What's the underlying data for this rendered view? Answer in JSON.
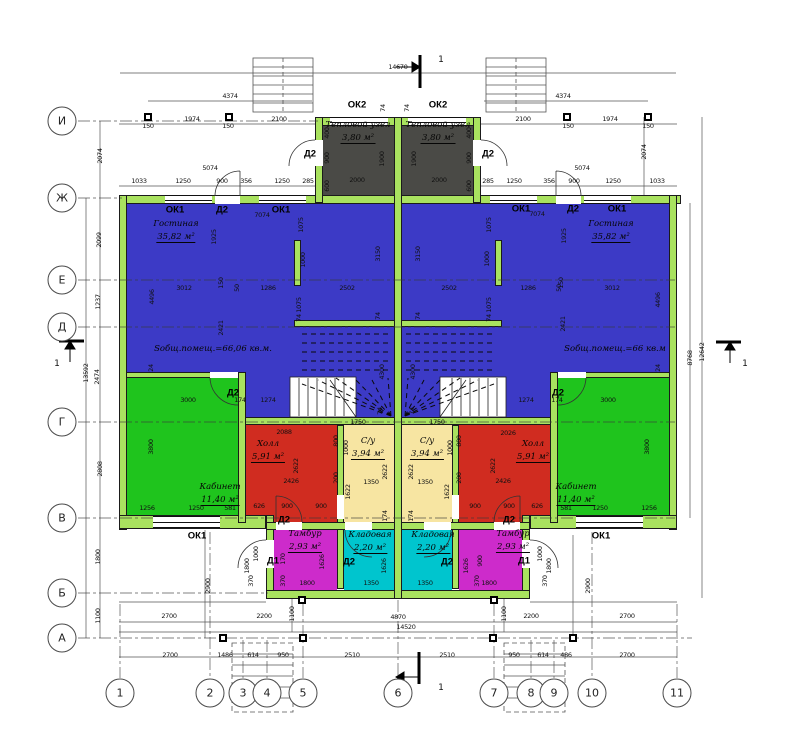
{
  "title": "Floor plan — duplex ground floor",
  "colors": {
    "wall": "#A9E25F",
    "blue": "#3C3AC6",
    "green": "#1FC41D",
    "red": "#D02C20",
    "cream": "#F7E5A2",
    "cyan": "#00C5CE",
    "magenta": "#CD2BCB",
    "dark": "#4A4A46",
    "line": "#444",
    "text": "#000"
  },
  "axes": {
    "left": [
      {
        "label": "И",
        "y": 121
      },
      {
        "label": "Ж",
        "y": 198
      },
      {
        "label": "Е",
        "y": 280
      },
      {
        "label": "Д",
        "y": 327
      },
      {
        "label": "Г",
        "y": 422
      },
      {
        "label": "В",
        "y": 518
      },
      {
        "label": "Б",
        "y": 593
      },
      {
        "label": "А",
        "y": 638
      }
    ],
    "bottom": [
      {
        "label": "1",
        "x": 120
      },
      {
        "label": "2",
        "x": 210
      },
      {
        "label": "3",
        "x": 243
      },
      {
        "label": "4",
        "x": 267
      },
      {
        "label": "5",
        "x": 303
      },
      {
        "label": "6",
        "x": 398
      },
      {
        "label": "7",
        "x": 494
      },
      {
        "label": "8",
        "x": 531
      },
      {
        "label": "9",
        "x": 554
      },
      {
        "label": "10",
        "x": 592
      },
      {
        "label": "11",
        "x": 677
      }
    ]
  },
  "rooms": [
    {
      "key": "heat-unit-left",
      "n": "Тепловой узел",
      "a": "3,80 м²",
      "c": "dark",
      "rects": [
        [
          323,
          125,
          71,
          78
        ]
      ],
      "lx": 358,
      "ly": 132
    },
    {
      "key": "heat-unit-right",
      "n": "Тепловой узел",
      "a": "3,80 м²",
      "c": "dark",
      "rects": [
        [
          402,
          125,
          71,
          78
        ]
      ],
      "lx": 438,
      "ly": 132
    },
    {
      "key": "living-left",
      "n": "Гостиная",
      "a": "35,82 м²",
      "c": "blue",
      "rects": [
        [
          127,
          204,
          267,
          169
        ],
        [
          246,
          373,
          148,
          52
        ]
      ],
      "lx": 176,
      "ly": 231
    },
    {
      "key": "living-right",
      "n": "Гостиная",
      "a": "35,82 м²",
      "c": "blue",
      "rects": [
        [
          402,
          204,
          267,
          169
        ],
        [
          402,
          373,
          148,
          52
        ]
      ],
      "lx": 611,
      "ly": 231
    },
    {
      "key": "office-left",
      "n": "Кабинет",
      "a": "11,40 м²",
      "c": "green",
      "rects": [
        [
          127,
          377,
          111,
          138
        ]
      ],
      "lx": 220,
      "ly": 494
    },
    {
      "key": "office-right",
      "n": "Кабинет",
      "a": "11,40 м²",
      "c": "green",
      "rects": [
        [
          558,
          377,
          111,
          138
        ]
      ],
      "lx": 576,
      "ly": 494
    },
    {
      "key": "hall-left",
      "n": "Холл",
      "a": "5,91 м²",
      "c": "red",
      "rects": [
        [
          246,
          425,
          91,
          97
        ]
      ],
      "lx": 268,
      "ly": 451
    },
    {
      "key": "hall-right",
      "n": "Холл",
      "a": "5,91 м²",
      "c": "red",
      "rects": [
        [
          459,
          425,
          91,
          97
        ]
      ],
      "lx": 533,
      "ly": 451
    },
    {
      "key": "bathroom-left",
      "n": "С/у",
      "a": "3,94 м²",
      "c": "cream",
      "rects": [
        [
          344,
          425,
          50,
          97
        ]
      ],
      "lx": 368,
      "ly": 448
    },
    {
      "key": "bathroom-right",
      "n": "С/у",
      "a": "3,94 м²",
      "c": "cream",
      "rects": [
        [
          402,
          425,
          50,
          97
        ]
      ],
      "lx": 427,
      "ly": 448
    },
    {
      "key": "storage-left",
      "n": "Кладовая",
      "a": "2,20 м²",
      "c": "cyan",
      "rects": [
        [
          344,
          530,
          50,
          60
        ]
      ],
      "lx": 370,
      "ly": 542
    },
    {
      "key": "storage-right",
      "n": "Кладовая",
      "a": "2,20 м²",
      "c": "cyan",
      "rects": [
        [
          402,
          530,
          50,
          60
        ]
      ],
      "lx": 433,
      "ly": 542
    },
    {
      "key": "vestibule-left",
      "n": "Тамбур",
      "a": "2,93 м²",
      "c": "magenta",
      "rects": [
        [
          274,
          530,
          63,
          60
        ]
      ],
      "lx": 305,
      "ly": 541
    },
    {
      "key": "vestibule-right",
      "n": "Тамбур",
      "a": "2,93 м²",
      "c": "magenta",
      "rects": [
        [
          459,
          530,
          63,
          60
        ]
      ],
      "lx": 513,
      "ly": 541
    }
  ],
  "annotations": [
    {
      "key": "total-area-left",
      "text": "Sобщ.помещ.=66,06 кв.м.",
      "x": 213,
      "y": 349
    },
    {
      "key": "total-area-right",
      "text": "Sобщ.помещ.=66 кв.м",
      "x": 615,
      "y": 349
    }
  ],
  "tags": [
    {
      "t": "ОК2",
      "x": 357,
      "y": 105
    },
    {
      "t": "ОК2",
      "x": 438,
      "y": 105
    },
    {
      "t": "Д2",
      "x": 310,
      "y": 154
    },
    {
      "t": "Д2",
      "x": 488,
      "y": 154
    },
    {
      "t": "ОК1",
      "x": 175,
      "y": 210
    },
    {
      "t": "Д2",
      "x": 222,
      "y": 210
    },
    {
      "t": "ОК1",
      "x": 281,
      "y": 210
    },
    {
      "t": "ОК1",
      "x": 521,
      "y": 209
    },
    {
      "t": "Д2",
      "x": 573,
      "y": 209
    },
    {
      "t": "ОК1",
      "x": 617,
      "y": 209
    },
    {
      "t": "Д2",
      "x": 233,
      "y": 393
    },
    {
      "t": "Д2",
      "x": 558,
      "y": 393
    },
    {
      "t": "Д2",
      "x": 284,
      "y": 520
    },
    {
      "t": "Д2",
      "x": 509,
      "y": 520
    },
    {
      "t": "Д1",
      "x": 273,
      "y": 561
    },
    {
      "t": "Д2",
      "x": 349,
      "y": 562
    },
    {
      "t": "Д2",
      "x": 447,
      "y": 562
    },
    {
      "t": "Д1",
      "x": 524,
      "y": 561
    },
    {
      "t": "ОК1",
      "x": 197,
      "y": 536
    },
    {
      "t": "ОК1",
      "x": 601,
      "y": 536
    }
  ],
  "section_labels": [
    {
      "t": "1",
      "x": 441,
      "y": 60
    },
    {
      "t": "1",
      "x": 441,
      "y": 688
    },
    {
      "t": "1",
      "x": 57,
      "y": 364
    },
    {
      "t": "1",
      "x": 745,
      "y": 364
    }
  ],
  "dims": [
    {
      "t": "14670",
      "x": 398,
      "y": 67
    },
    {
      "t": "4374",
      "x": 230,
      "y": 96
    },
    {
      "t": "4374",
      "x": 563,
      "y": 96
    },
    {
      "t": "1974",
      "x": 192,
      "y": 119
    },
    {
      "t": "2100",
      "x": 279,
      "y": 119
    },
    {
      "t": "2100",
      "x": 523,
      "y": 119
    },
    {
      "t": "1974",
      "x": 610,
      "y": 119
    },
    {
      "t": "150",
      "x": 148,
      "y": 126
    },
    {
      "t": "150",
      "x": 228,
      "y": 126
    },
    {
      "t": "150",
      "x": 568,
      "y": 126
    },
    {
      "t": "150",
      "x": 648,
      "y": 126
    },
    {
      "t": "5074",
      "x": 210,
      "y": 168
    },
    {
      "t": "5074",
      "x": 582,
      "y": 168
    },
    {
      "t": "2074",
      "x": 100,
      "y": 156,
      "r": 1
    },
    {
      "t": "2074",
      "x": 644,
      "y": 152,
      "r": 1
    },
    {
      "t": "1033",
      "x": 139,
      "y": 181
    },
    {
      "t": "1250",
      "x": 183,
      "y": 181
    },
    {
      "t": "900",
      "x": 222,
      "y": 181
    },
    {
      "t": "356",
      "x": 246,
      "y": 181
    },
    {
      "t": "1250",
      "x": 282,
      "y": 181
    },
    {
      "t": "285",
      "x": 308,
      "y": 181
    },
    {
      "t": "285",
      "x": 488,
      "y": 181
    },
    {
      "t": "1250",
      "x": 514,
      "y": 181
    },
    {
      "t": "356",
      "x": 549,
      "y": 181
    },
    {
      "t": "900",
      "x": 574,
      "y": 181
    },
    {
      "t": "1250",
      "x": 613,
      "y": 181
    },
    {
      "t": "1033",
      "x": 657,
      "y": 181
    },
    {
      "t": "74",
      "x": 383,
      "y": 108,
      "r": 1
    },
    {
      "t": "74",
      "x": 407,
      "y": 108,
      "r": 1
    },
    {
      "t": "400",
      "x": 327,
      "y": 133,
      "r": 1
    },
    {
      "t": "400",
      "x": 469,
      "y": 133,
      "r": 1
    },
    {
      "t": "900",
      "x": 327,
      "y": 158,
      "r": 1
    },
    {
      "t": "900",
      "x": 469,
      "y": 158,
      "r": 1
    },
    {
      "t": "1900",
      "x": 382,
      "y": 159,
      "r": 1
    },
    {
      "t": "1900",
      "x": 414,
      "y": 159,
      "r": 1
    },
    {
      "t": "600",
      "x": 327,
      "y": 186,
      "r": 1
    },
    {
      "t": "600",
      "x": 469,
      "y": 186,
      "r": 1
    },
    {
      "t": "2000",
      "x": 357,
      "y": 180
    },
    {
      "t": "2000",
      "x": 439,
      "y": 180
    },
    {
      "t": "7074",
      "x": 262,
      "y": 215
    },
    {
      "t": "7074",
      "x": 537,
      "y": 214
    },
    {
      "t": "2099",
      "x": 99,
      "y": 240,
      "r": 1
    },
    {
      "t": "1237",
      "x": 98,
      "y": 302,
      "r": 1
    },
    {
      "t": "2474",
      "x": 97,
      "y": 377,
      "r": 1
    },
    {
      "t": "13592",
      "x": 86,
      "y": 373,
      "r": 1
    },
    {
      "t": "2808",
      "x": 100,
      "y": 469,
      "r": 1
    },
    {
      "t": "1800",
      "x": 98,
      "y": 557,
      "r": 1
    },
    {
      "t": "1100",
      "x": 98,
      "y": 616,
      "r": 1
    },
    {
      "t": "8768",
      "x": 690,
      "y": 358,
      "r": 1
    },
    {
      "t": "12642",
      "x": 702,
      "y": 352,
      "r": 1
    },
    {
      "t": "1075",
      "x": 301,
      "y": 225,
      "r": 1
    },
    {
      "t": "1075",
      "x": 489,
      "y": 225,
      "r": 1
    },
    {
      "t": "1925",
      "x": 214,
      "y": 237,
      "r": 1
    },
    {
      "t": "1925",
      "x": 564,
      "y": 236,
      "r": 1
    },
    {
      "t": "1000",
      "x": 303,
      "y": 260,
      "r": 1
    },
    {
      "t": "1000",
      "x": 487,
      "y": 259,
      "r": 1
    },
    {
      "t": "3150",
      "x": 378,
      "y": 254,
      "r": 1
    },
    {
      "t": "3150",
      "x": 418,
      "y": 254,
      "r": 1
    },
    {
      "t": "3012",
      "x": 184,
      "y": 288
    },
    {
      "t": "1286",
      "x": 268,
      "y": 288
    },
    {
      "t": "2502",
      "x": 347,
      "y": 288
    },
    {
      "t": "2502",
      "x": 449,
      "y": 288
    },
    {
      "t": "1286",
      "x": 528,
      "y": 288
    },
    {
      "t": "3012",
      "x": 612,
      "y": 288
    },
    {
      "t": "150",
      "x": 221,
      "y": 283,
      "r": 1
    },
    {
      "t": "50",
      "x": 237,
      "y": 288,
      "r": 1
    },
    {
      "t": "150",
      "x": 561,
      "y": 283,
      "r": 1
    },
    {
      "t": "50",
      "x": 559,
      "y": 288,
      "r": 1
    },
    {
      "t": "4496",
      "x": 152,
      "y": 297,
      "r": 1
    },
    {
      "t": "4496",
      "x": 658,
      "y": 300,
      "r": 1
    },
    {
      "t": "2421",
      "x": 221,
      "y": 328,
      "r": 1
    },
    {
      "t": "2421",
      "x": 563,
      "y": 324,
      "r": 1
    },
    {
      "t": "1075",
      "x": 299,
      "y": 305,
      "r": 1
    },
    {
      "t": "1075",
      "x": 489,
      "y": 305,
      "r": 1
    },
    {
      "t": "74",
      "x": 299,
      "y": 318,
      "r": 1
    },
    {
      "t": "74",
      "x": 489,
      "y": 318,
      "r": 1
    },
    {
      "t": "74",
      "x": 378,
      "y": 316,
      "r": 1
    },
    {
      "t": "74",
      "x": 418,
      "y": 316,
      "r": 1
    },
    {
      "t": "24",
      "x": 151,
      "y": 368,
      "r": 1
    },
    {
      "t": "24",
      "x": 658,
      "y": 368,
      "r": 1
    },
    {
      "t": "4300",
      "x": 382,
      "y": 372,
      "r": 1
    },
    {
      "t": "4300",
      "x": 413,
      "y": 372,
      "r": 1
    },
    {
      "t": "3000",
      "x": 188,
      "y": 400
    },
    {
      "t": "174",
      "x": 240,
      "y": 400
    },
    {
      "t": "1274",
      "x": 268,
      "y": 400
    },
    {
      "t": "1274",
      "x": 526,
      "y": 400
    },
    {
      "t": "174",
      "x": 557,
      "y": 400
    },
    {
      "t": "3000",
      "x": 608,
      "y": 400
    },
    {
      "t": "74",
      "x": 380,
      "y": 411,
      "r": 1
    },
    {
      "t": "74",
      "x": 412,
      "y": 411,
      "r": 1
    },
    {
      "t": "3800",
      "x": 151,
      "y": 447,
      "r": 1
    },
    {
      "t": "3800",
      "x": 647,
      "y": 447,
      "r": 1
    },
    {
      "t": "1256",
      "x": 147,
      "y": 508
    },
    {
      "t": "1250",
      "x": 196,
      "y": 508
    },
    {
      "t": "581",
      "x": 230,
      "y": 508
    },
    {
      "t": "581",
      "x": 566,
      "y": 508
    },
    {
      "t": "1250",
      "x": 600,
      "y": 508
    },
    {
      "t": "1256",
      "x": 649,
      "y": 508
    },
    {
      "t": "2088",
      "x": 284,
      "y": 432
    },
    {
      "t": "2026",
      "x": 508,
      "y": 433
    },
    {
      "t": "1750",
      "x": 358,
      "y": 422
    },
    {
      "t": "1750",
      "x": 437,
      "y": 422
    },
    {
      "t": "800",
      "x": 336,
      "y": 441,
      "r": 1
    },
    {
      "t": "800",
      "x": 459,
      "y": 441,
      "r": 1
    },
    {
      "t": "1000",
      "x": 346,
      "y": 448,
      "r": 1
    },
    {
      "t": "1000",
      "x": 450,
      "y": 448,
      "r": 1
    },
    {
      "t": "2622",
      "x": 296,
      "y": 466,
      "r": 1
    },
    {
      "t": "2622",
      "x": 493,
      "y": 466,
      "r": 1
    },
    {
      "t": "2622",
      "x": 385,
      "y": 472,
      "r": 1
    },
    {
      "t": "2622",
      "x": 411,
      "y": 472,
      "r": 1
    },
    {
      "t": "2426",
      "x": 291,
      "y": 481
    },
    {
      "t": "2426",
      "x": 503,
      "y": 481
    },
    {
      "t": "200",
      "x": 336,
      "y": 478,
      "r": 1
    },
    {
      "t": "200",
      "x": 459,
      "y": 478,
      "r": 1
    },
    {
      "t": "1350",
      "x": 371,
      "y": 482
    },
    {
      "t": "1350",
      "x": 425,
      "y": 482
    },
    {
      "t": "1622",
      "x": 348,
      "y": 492,
      "r": 1
    },
    {
      "t": "1622",
      "x": 447,
      "y": 492,
      "r": 1
    },
    {
      "t": "626",
      "x": 259,
      "y": 506
    },
    {
      "t": "900",
      "x": 287,
      "y": 506
    },
    {
      "t": "900",
      "x": 321,
      "y": 506
    },
    {
      "t": "900",
      "x": 475,
      "y": 506
    },
    {
      "t": "900",
      "x": 509,
      "y": 506
    },
    {
      "t": "626",
      "x": 537,
      "y": 506
    },
    {
      "t": "174",
      "x": 385,
      "y": 516,
      "r": 1
    },
    {
      "t": "174",
      "x": 411,
      "y": 516,
      "r": 1
    },
    {
      "t": "170",
      "x": 283,
      "y": 559,
      "r": 1
    },
    {
      "t": "1626",
      "x": 322,
      "y": 562,
      "r": 1
    },
    {
      "t": "1626",
      "x": 384,
      "y": 566,
      "r": 1
    },
    {
      "t": "1626",
      "x": 466,
      "y": 566,
      "r": 1
    },
    {
      "t": "900",
      "x": 480,
      "y": 561,
      "r": 1
    },
    {
      "t": "370",
      "x": 283,
      "y": 581,
      "r": 1
    },
    {
      "t": "370",
      "x": 477,
      "y": 581,
      "r": 1
    },
    {
      "t": "1800",
      "x": 307,
      "y": 583
    },
    {
      "t": "1350",
      "x": 371,
      "y": 583
    },
    {
      "t": "1350",
      "x": 425,
      "y": 583
    },
    {
      "t": "1800",
      "x": 489,
      "y": 583
    },
    {
      "t": "1000",
      "x": 256,
      "y": 554,
      "r": 1
    },
    {
      "t": "1800",
      "x": 247,
      "y": 566,
      "r": 1
    },
    {
      "t": "370",
      "x": 251,
      "y": 581,
      "r": 1
    },
    {
      "t": "1000",
      "x": 540,
      "y": 554,
      "r": 1
    },
    {
      "t": "1800",
      "x": 549,
      "y": 566,
      "r": 1
    },
    {
      "t": "370",
      "x": 545,
      "y": 581,
      "r": 1
    },
    {
      "t": "2900",
      "x": 208,
      "y": 586,
      "r": 1
    },
    {
      "t": "2900",
      "x": 588,
      "y": 586,
      "r": 1
    },
    {
      "t": "1100",
      "x": 292,
      "y": 614,
      "r": 1
    },
    {
      "t": "1100",
      "x": 504,
      "y": 614,
      "r": 1
    },
    {
      "t": "2700",
      "x": 169,
      "y": 616
    },
    {
      "t": "2200",
      "x": 264,
      "y": 616
    },
    {
      "t": "4870",
      "x": 398,
      "y": 617
    },
    {
      "t": "2200",
      "x": 531,
      "y": 616
    },
    {
      "t": "2700",
      "x": 627,
      "y": 616
    },
    {
      "t": "14520",
      "x": 406,
      "y": 627
    },
    {
      "t": "2700",
      "x": 170,
      "y": 655
    },
    {
      "t": "1486",
      "x": 225,
      "y": 655
    },
    {
      "t": "614",
      "x": 253,
      "y": 655
    },
    {
      "t": "950",
      "x": 283,
      "y": 655
    },
    {
      "t": "2510",
      "x": 352,
      "y": 655
    },
    {
      "t": "2510",
      "x": 447,
      "y": 655
    },
    {
      "t": "950",
      "x": 514,
      "y": 655
    },
    {
      "t": "614",
      "x": 543,
      "y": 655
    },
    {
      "t": "486",
      "x": 566,
      "y": 655
    },
    {
      "t": "2700",
      "x": 627,
      "y": 655
    }
  ]
}
